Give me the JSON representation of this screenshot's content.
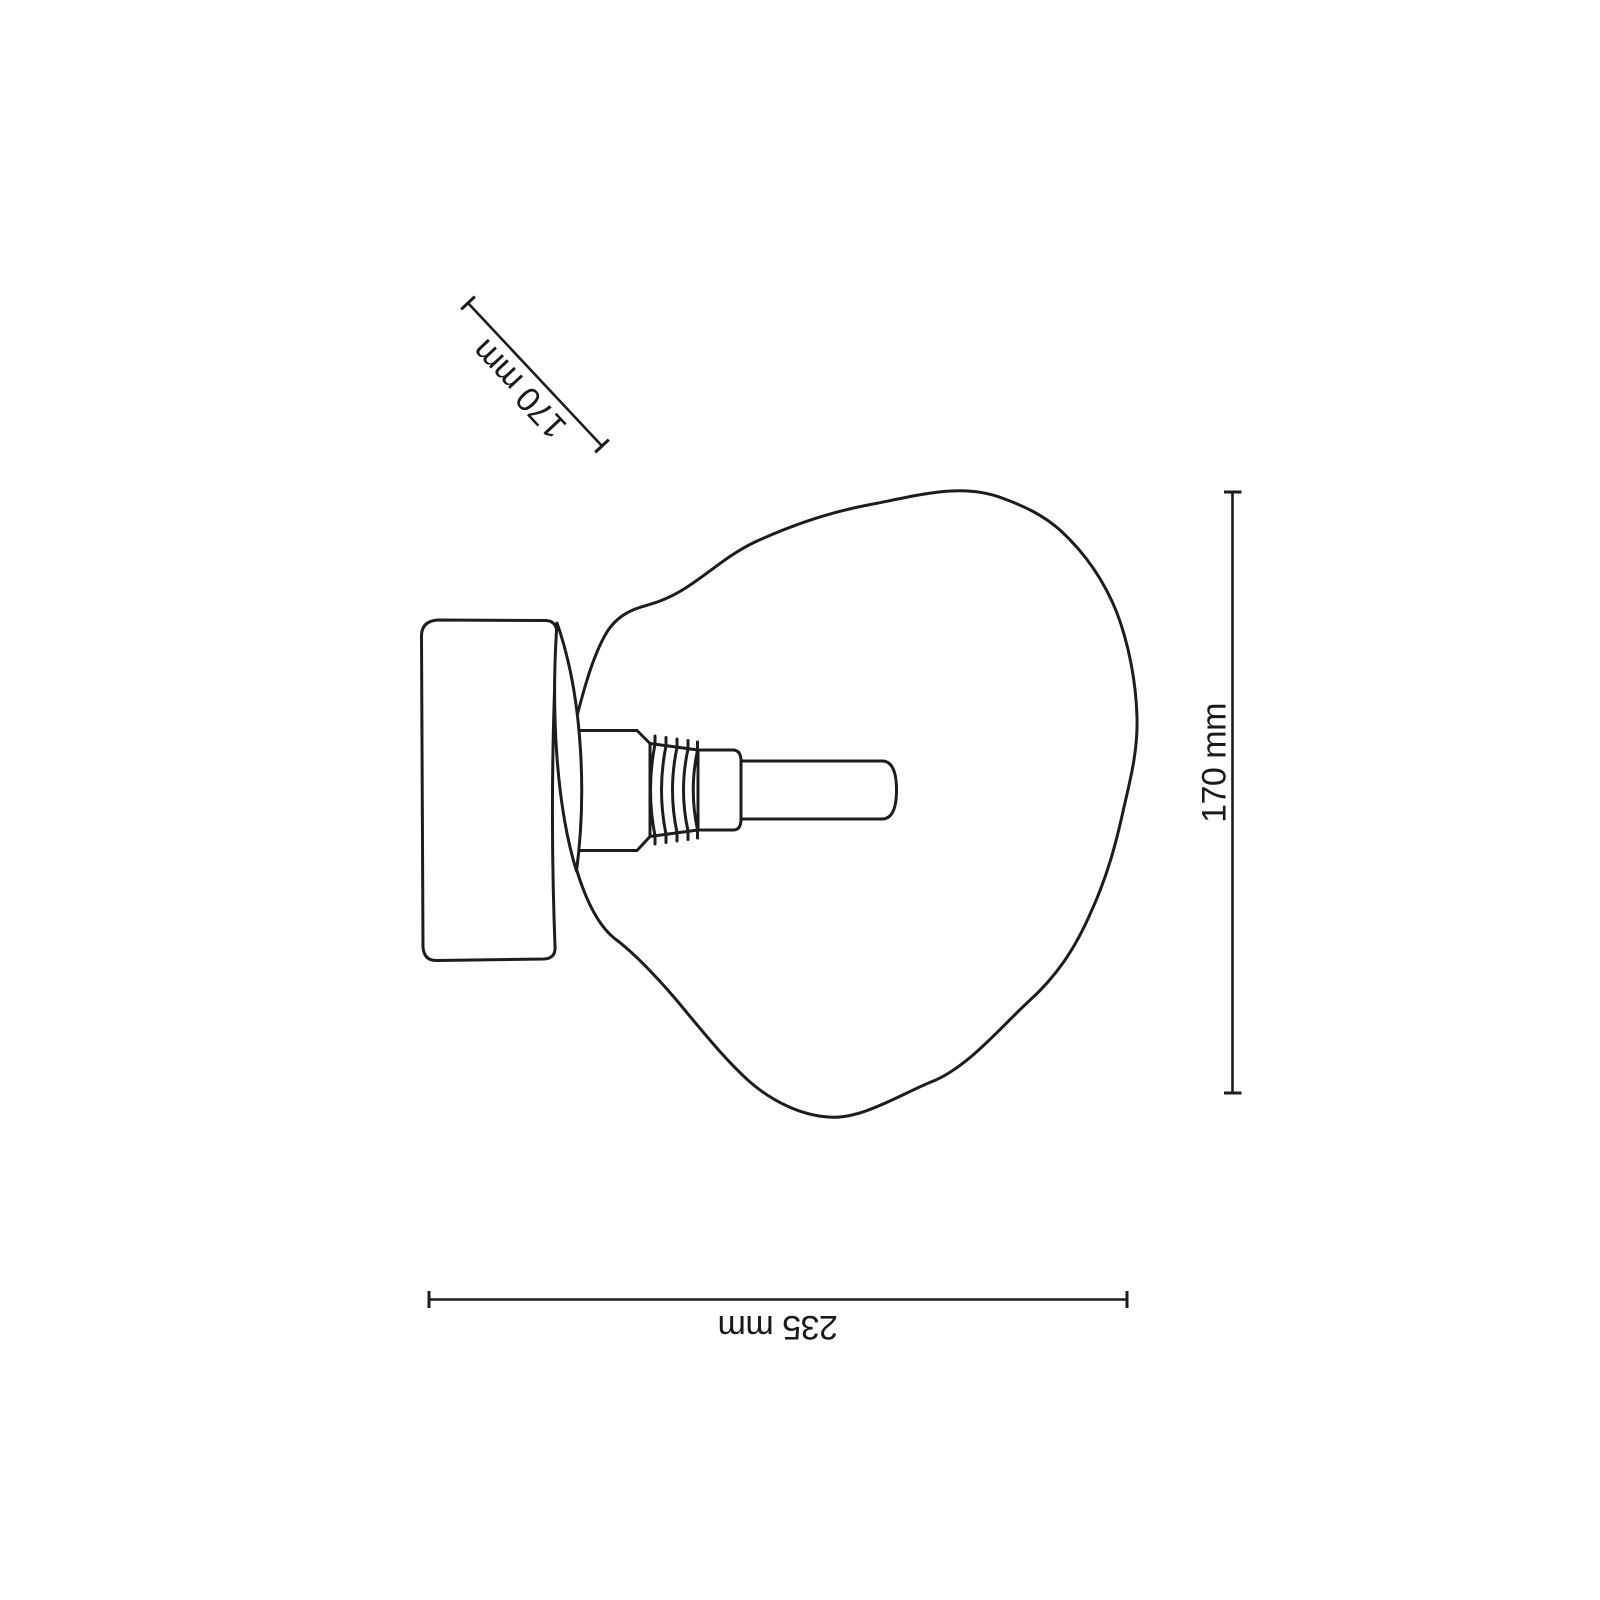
{
  "drawing": {
    "dimensions": {
      "diagonal_label": "170 mm",
      "vertical_label": "170 mm",
      "horizontal_label": "235 mm"
    },
    "colors": {
      "background": "#ffffff",
      "stroke": "#1d1d1b",
      "text": "#1a1a1a"
    }
  }
}
